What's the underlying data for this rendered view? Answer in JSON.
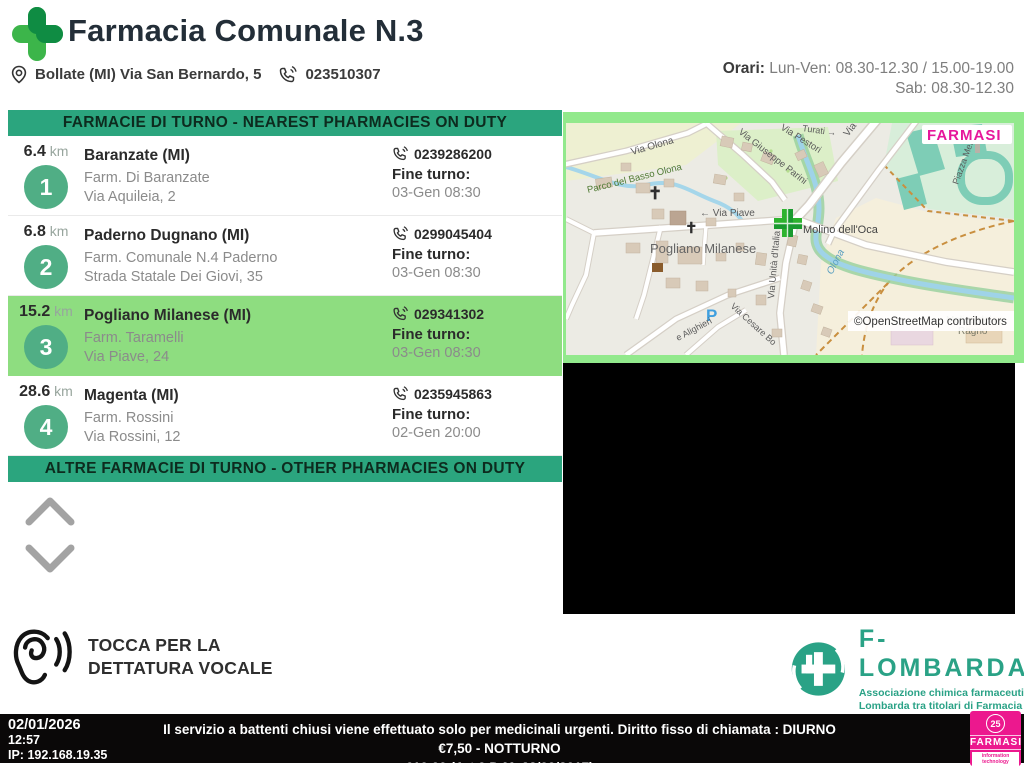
{
  "header": {
    "title": "Farmacia Comunale N.3",
    "address": "Bollate (MI) Via San Bernardo, 5",
    "phone": "023510307",
    "orari_label": "Orari:",
    "orari_line1": " Lun-Ven: 08.30-12.30 / 15.00-19.00",
    "orari_line2": "Sab: 08.30-12.30"
  },
  "list": {
    "banner_top": "FARMACIE DI TURNO - NEAREST PHARMACIES ON DUTY",
    "banner_bottom": "ALTRE FARMACIE DI TURNO - OTHER PHARMACIES ON DUTY",
    "fine_turno_label": "Fine turno:",
    "items": [
      {
        "rank": "1",
        "distance": "6.4",
        "unit": " km",
        "city": "Baranzate (MI)",
        "name": "Farm. Di Baranzate",
        "street": "Via Aquileia, 2",
        "phone": "0239286200",
        "fine_turno": "03-Gen 08:30",
        "selected": false
      },
      {
        "rank": "2",
        "distance": "6.8",
        "unit": " km",
        "city": "Paderno Dugnano (MI)",
        "name": "Farm. Comunale N.4 Paderno",
        "street": "Strada Statale Dei Giovi, 35",
        "phone": "0299045404",
        "fine_turno": "03-Gen 08:30",
        "selected": false
      },
      {
        "rank": "3",
        "distance": "15.2",
        "unit": " km",
        "city": "Pogliano Milanese (MI)",
        "name": "Farm. Taramelli",
        "street": "Via Piave, 24",
        "phone": "029341302",
        "fine_turno": "03-Gen 08:30",
        "selected": true
      },
      {
        "rank": "4",
        "distance": "28.6",
        "unit": " km",
        "city": "Magenta (MI)",
        "name": "Farm. Rossini",
        "street": "Via Rossini, 12",
        "phone": "0235945863",
        "fine_turno": "02-Gen 20:00",
        "selected": false
      }
    ]
  },
  "map": {
    "brand": "FARMASI",
    "attribution": "©OpenStreetMap contributors",
    "labels": {
      "via_olona": "Via Olona",
      "parco": "Parco del Basso Olona",
      "parini": "Via Giuseppe Parini",
      "pestori": "Via Pestori",
      "turati": "Turati →",
      "europa": "Via Europa",
      "piazza": "Piazza Merca",
      "pogliano": "Pogliano Milanese",
      "piave": "← Via Piave",
      "unita": "Via Unità d'Italia",
      "oca": "Molino dell'Oca",
      "olona_river": "Olona",
      "ragno1": "Molino del",
      "ragno2": "Ragno",
      "cesare": "Via Cesare Bo",
      "alighieri": "e Alighieri",
      "parking": "P"
    }
  },
  "voice": {
    "line1": "TOCCA PER LA",
    "line2": "DETTATURA VOCALE"
  },
  "flombarda": {
    "name": "F-LOMBARDA",
    "sub1": "Associazione chimica farmaceutica",
    "sub2": "Lombarda tra titolari di Farmacia"
  },
  "footer": {
    "date": "02/01/2026",
    "time": "12:57",
    "ip": "IP: 192.168.19.35",
    "notice1": "Il servizio a battenti chiusi viene effettuato solo per medicinali urgenti. Diritto fisso di chiamata : DIURNO €7,50 - NOTTURNO",
    "notice2": "€10,00 (Art.9 D.M. 22/09/2017)",
    "brand": "FARMASI",
    "brand_badge": "25",
    "brand_sub": "information technology"
  },
  "colors": {
    "banner_green": "#2ba57e",
    "selected_green": "#8edd80",
    "map_frame_green": "#92e98c",
    "badge_green": "#50ae85",
    "logo_dark_green": "#0f8c43",
    "logo_light_green": "#3cb54a",
    "farmasi_magenta": "#ec188e",
    "flombarda_teal": "#2aa286",
    "footer_black": "#0a0808"
  }
}
